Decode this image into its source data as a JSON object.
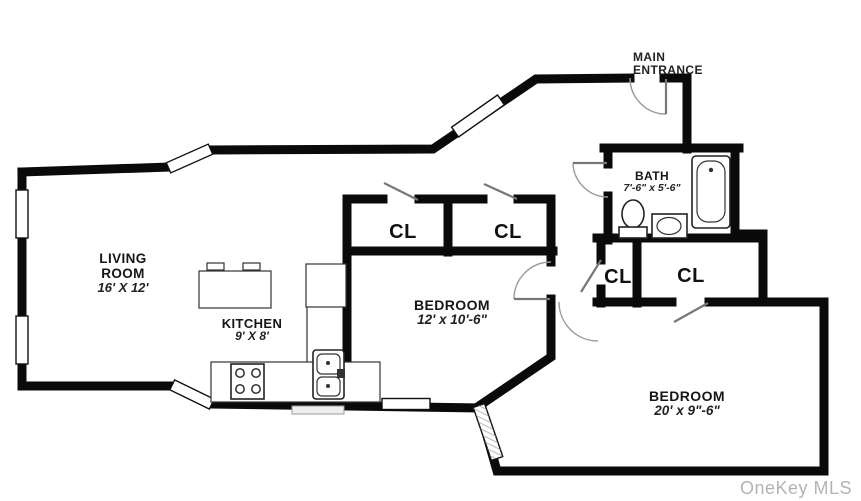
{
  "title": "Apartment floor plan",
  "rooms": {
    "living_room": {
      "line1": "LIVING",
      "line2": "ROOM",
      "dims": "16' X 12'"
    },
    "kitchen": {
      "label": "KITCHEN",
      "dims": "9' X 8'"
    },
    "bedroom1": {
      "label": "BEDROOM",
      "dims": "12' x 10'-6\""
    },
    "bath": {
      "label": "BATH",
      "dims": "7'-6\" x 5'-6\""
    },
    "bedroom2": {
      "label": "BEDROOM",
      "dims": "20' x 9\"-6\""
    }
  },
  "closets": {
    "bedroom1_left": "CL",
    "bedroom1_right": "CL",
    "hall_small": "CL",
    "hall_large": "CL"
  },
  "entrance": {
    "line1": "MAIN",
    "line2": "ENTRANCE"
  },
  "watermark": "OneKey MLS",
  "colors": {
    "wall": "#0a0a0a",
    "door_swing": "#9a9a9a",
    "door_leaf": "#777777",
    "label_text": "#161616",
    "watermark_text": "#b3b3b3"
  },
  "fixtures": {
    "bathtub": "bathtub",
    "toilet": "toilet",
    "bath_sink": "bath-sink",
    "kitchen_island": "kitchen-island",
    "stove": "stove",
    "kitchen_sink": "kitchen-sink",
    "refrigerator": "refrigerator"
  }
}
